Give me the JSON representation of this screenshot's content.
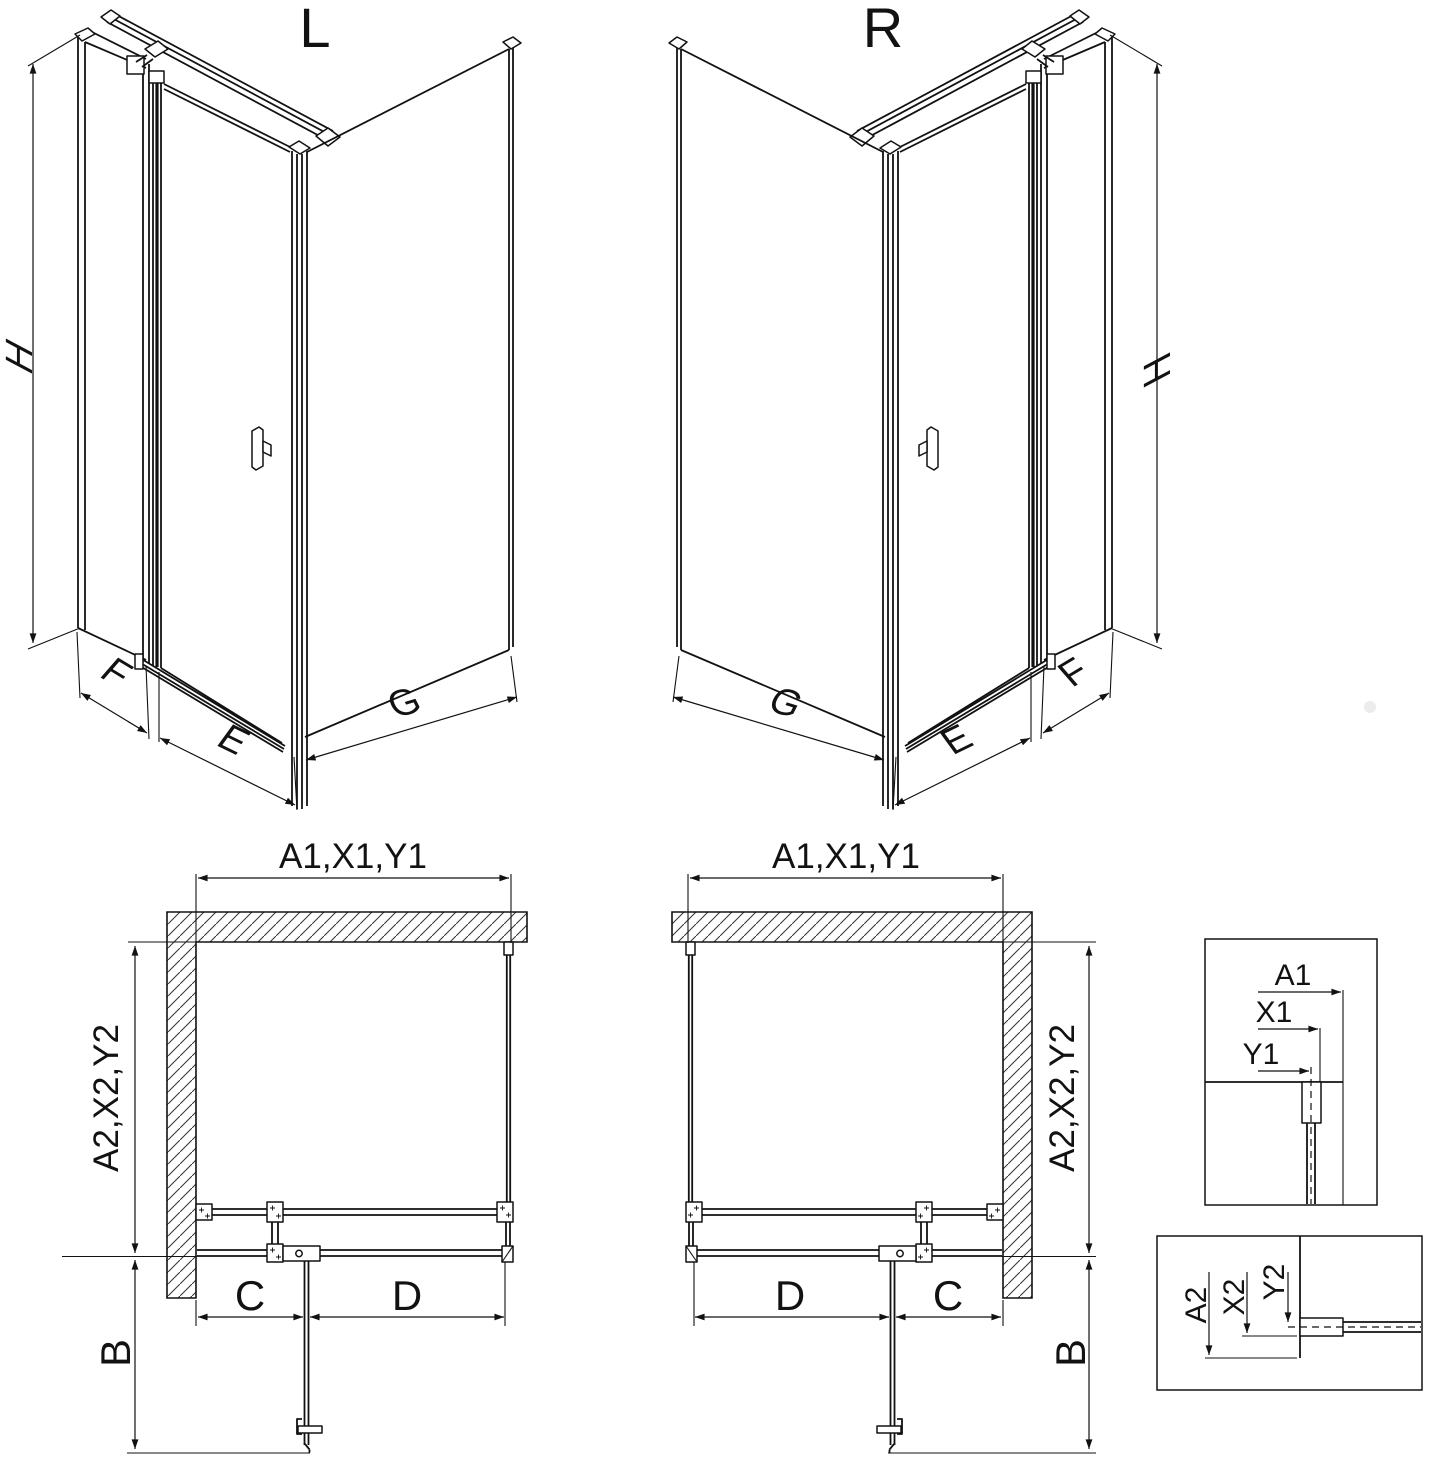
{
  "page": {
    "background": "#ffffff",
    "line_color": "#121212"
  },
  "views": {
    "left_3d": {
      "label": "L",
      "height_dim": "H",
      "side_dim": "F",
      "door_dim": "E",
      "return_dim": "G"
    },
    "right_3d": {
      "label": "R",
      "height_dim": "H",
      "side_dim": "F",
      "door_dim": "E",
      "return_dim": "G"
    },
    "left_plan": {
      "width_dim": "A1,X1,Y1",
      "depth_dim": "A2,X2,Y2",
      "fixed_dim": "C",
      "door_dim": "D",
      "swing_dim": "B"
    },
    "right_plan": {
      "width_dim": "A1,X1,Y1",
      "depth_dim": "A2,X2,Y2",
      "fixed_dim": "C",
      "door_dim": "D",
      "swing_dim": "B"
    },
    "detail_top": {
      "a1": "A1",
      "x1": "X1",
      "y1": "Y1"
    },
    "detail_bottom": {
      "a2": "A2",
      "x2": "X2",
      "y2": "Y2"
    }
  }
}
